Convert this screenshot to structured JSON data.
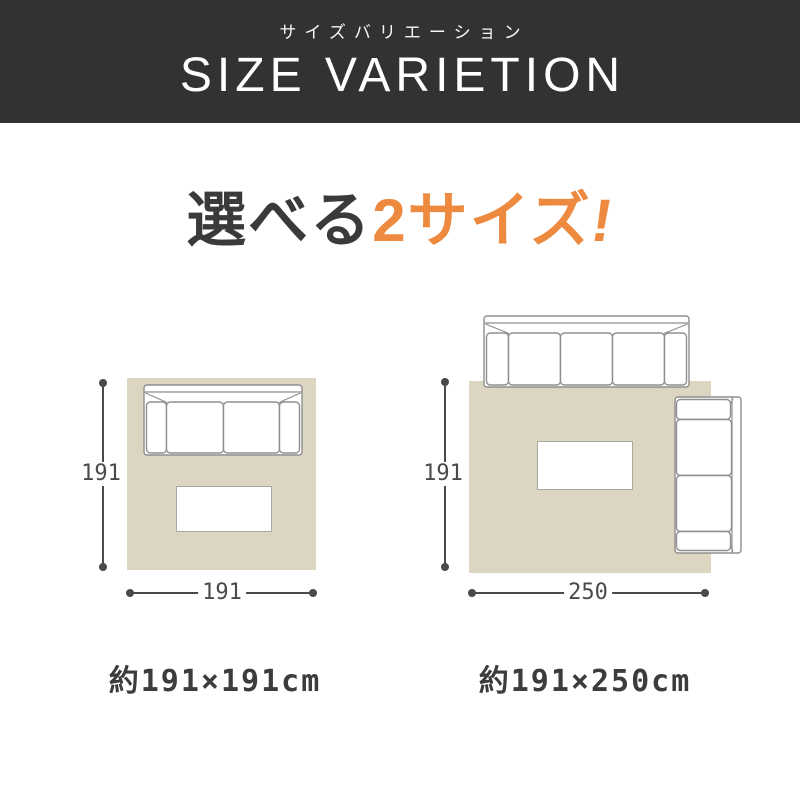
{
  "header": {
    "subtitle_jp": "サイズバリエーション",
    "title_en": "SIZE VARIETION",
    "bg_color": "#323232",
    "text_color": "#ffffff"
  },
  "headline": {
    "black_part": "選べる",
    "orange_part": "2サイズ",
    "exclamation": "!",
    "black_color": "#3a3a3a",
    "orange_color": "#ed8a3f"
  },
  "sizes": [
    {
      "id": "191x191",
      "height_cm": "191",
      "width_cm": "191",
      "caption": "約191×191cm",
      "furniture": [
        "two-seat-sofa",
        "low-table"
      ]
    },
    {
      "id": "191x250",
      "height_cm": "191",
      "width_cm": "250",
      "caption": "約191×250cm",
      "furniture": [
        "three-seat-sofa",
        "two-seat-sofa",
        "low-table"
      ]
    }
  ],
  "style_colors": {
    "rug_beige": "#dbd5c1",
    "dimension_gray": "#4a4a4a",
    "sofa_outline_gray": "#8f8f8f"
  }
}
